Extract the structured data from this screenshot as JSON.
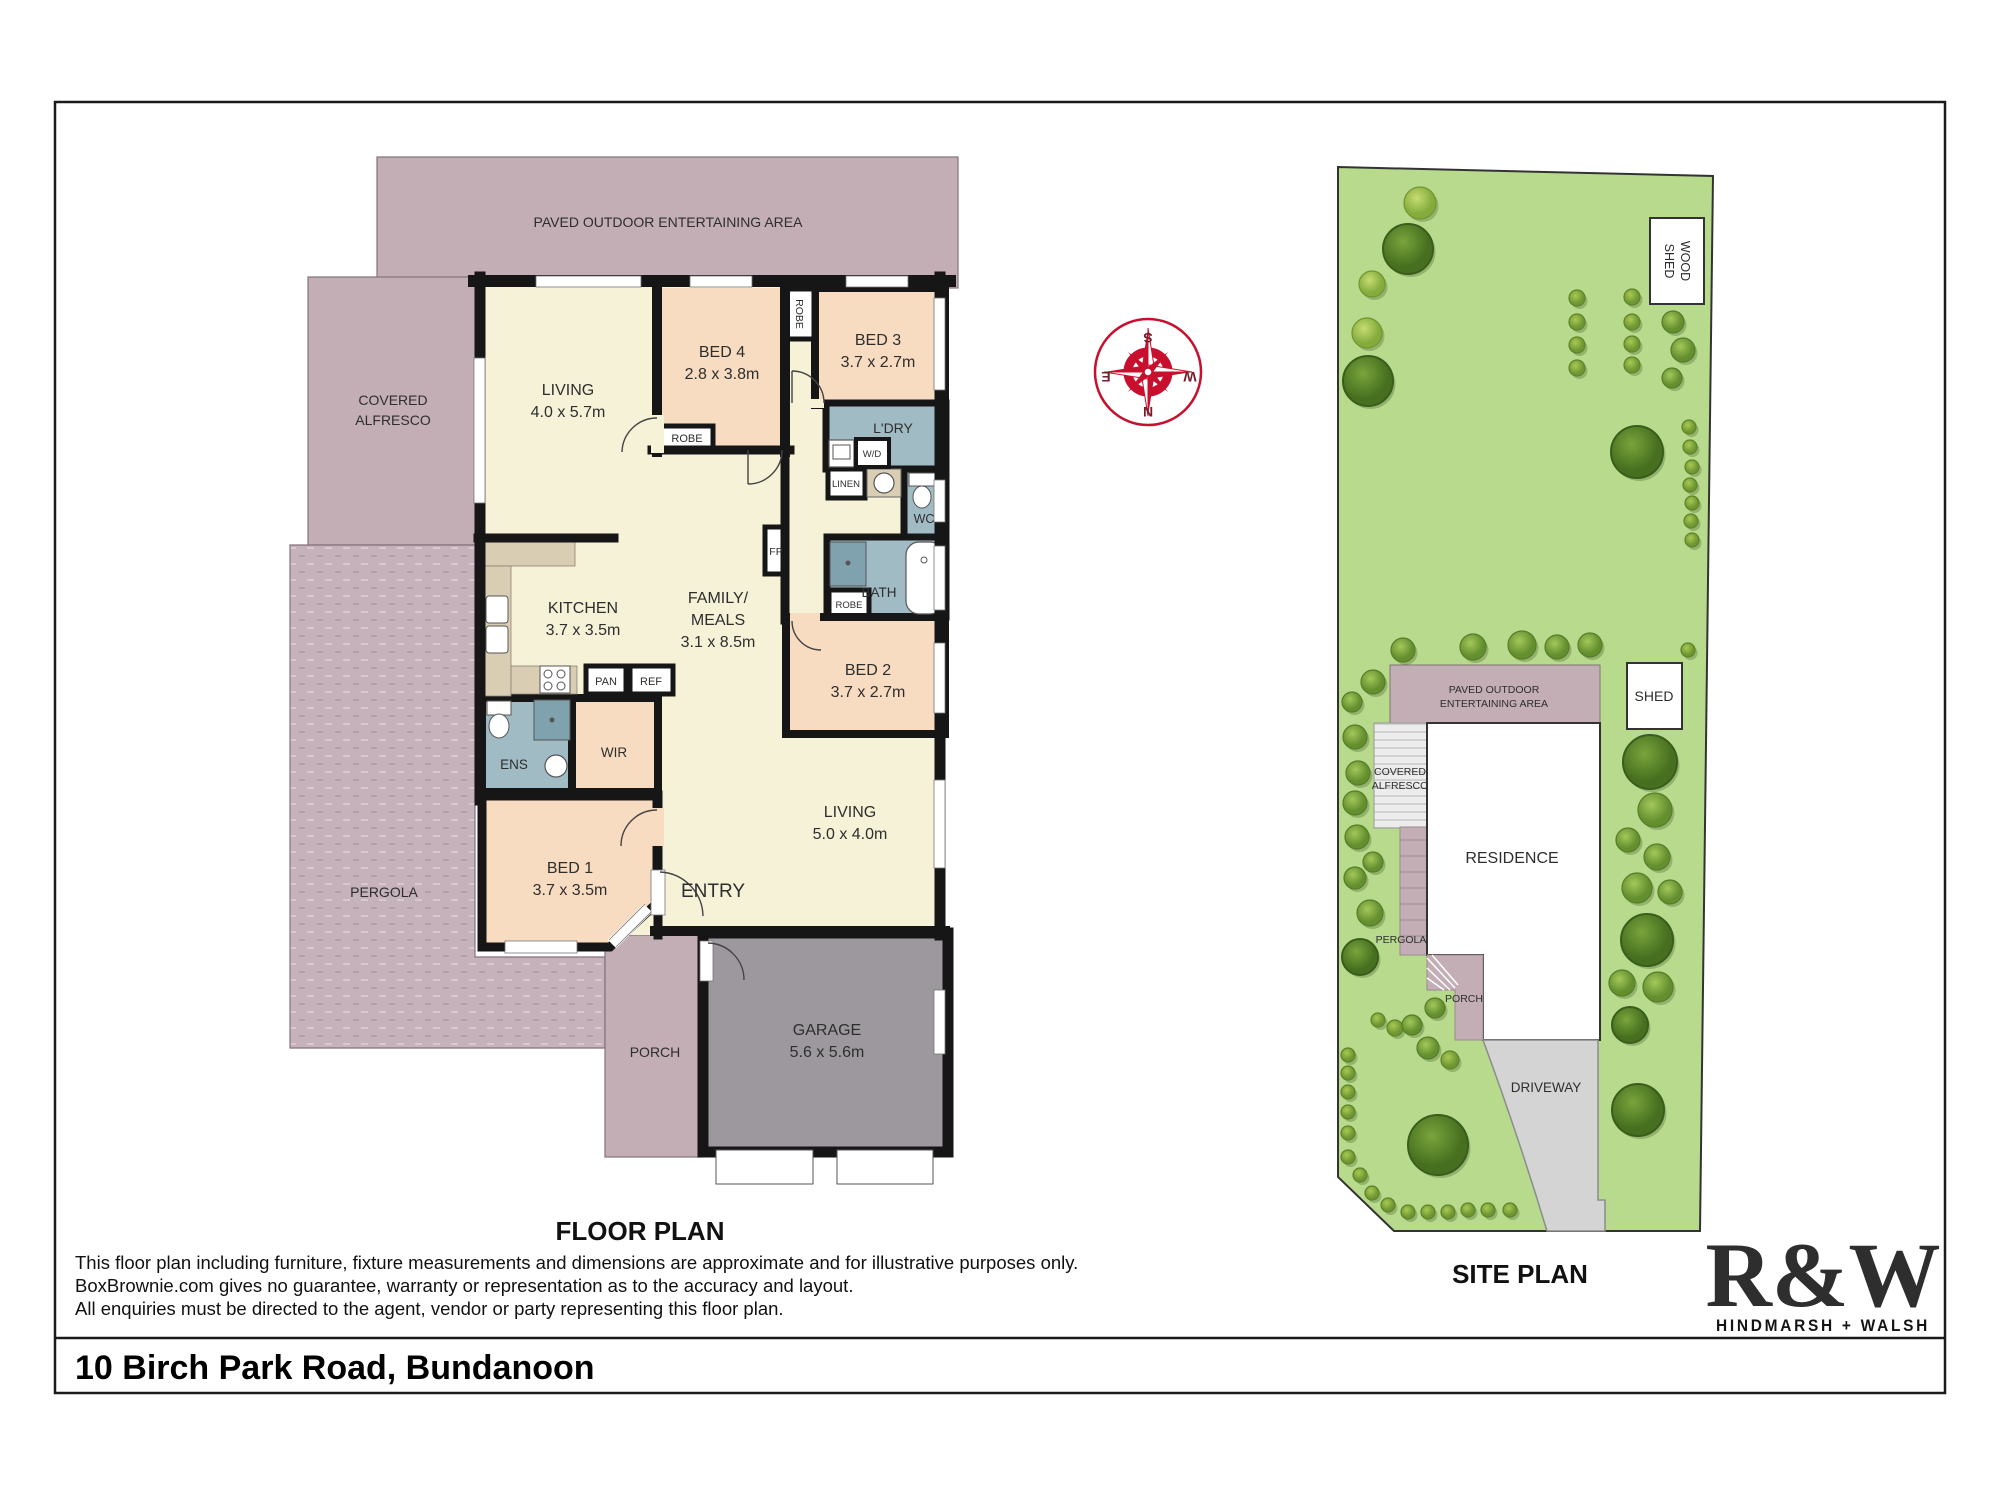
{
  "floor_plan": {
    "title": "FLOOR PLAN",
    "rooms": {
      "paved_area": {
        "label": "PAVED OUTDOOR ENTERTAINING AREA"
      },
      "covered_alfresco": {
        "line1": "COVERED",
        "line2": "ALFRESCO"
      },
      "pergola": {
        "label": "PERGOLA"
      },
      "porch": {
        "label": "PORCH"
      },
      "living1": {
        "label": "LIVING",
        "dims": "4.0 x 5.7m"
      },
      "bed4": {
        "label": "BED 4",
        "dims": "2.8 x 3.8m"
      },
      "bed3": {
        "label": "BED 3",
        "dims": "3.7 x 2.7m"
      },
      "ldry": {
        "label": "L'DRY"
      },
      "wd": {
        "label": "W/D"
      },
      "linen": {
        "label": "LINEN"
      },
      "wc": {
        "label": "WC"
      },
      "bath": {
        "label": "BATH"
      },
      "robe": {
        "label": "ROBE"
      },
      "kitchen": {
        "label": "KITCHEN",
        "dims": "3.7 x 3.5m"
      },
      "family": {
        "line1": "FAMILY/",
        "line2": "MEALS",
        "dims": "3.1 x 8.5m"
      },
      "fp": {
        "label": "FP"
      },
      "pan": {
        "label": "PAN"
      },
      "ref": {
        "label": "REF"
      },
      "bed2": {
        "label": "BED 2",
        "dims": "3.7 x 2.7m"
      },
      "living2": {
        "label": "LIVING",
        "dims": "5.0 x 4.0m"
      },
      "ens": {
        "label": "ENS"
      },
      "wir": {
        "label": "WIR"
      },
      "bed1": {
        "label": "BED 1",
        "dims": "3.7 x 3.5m"
      },
      "entry": {
        "label": "ENTRY"
      },
      "garage": {
        "label": "GARAGE",
        "dims": "5.6 x 5.6m"
      }
    }
  },
  "site_plan": {
    "title": "SITE PLAN",
    "labels": {
      "wood_shed_line1": "WOOD",
      "wood_shed_line2": "SHED",
      "shed": "SHED",
      "paved_line1": "PAVED OUTDOOR",
      "paved_line2": "ENTERTAINING AREA",
      "alfresco_line1": "COVERED",
      "alfresco_line2": "ALFRESCO",
      "residence": "RESIDENCE",
      "pergola": "PERGOLA",
      "porch": "PORCH",
      "driveway": "DRIVEWAY"
    },
    "trees": [
      [
        1420,
        203,
        16,
        "s"
      ],
      [
        1408,
        249,
        25,
        "b"
      ],
      [
        1372,
        284,
        13,
        "s"
      ],
      [
        1367,
        333,
        15,
        "s"
      ],
      [
        1368,
        381,
        25,
        "b"
      ],
      [
        1577,
        298,
        8,
        "t"
      ],
      [
        1632,
        297,
        8,
        "t"
      ],
      [
        1577,
        322,
        8,
        "t"
      ],
      [
        1632,
        322,
        8,
        "t"
      ],
      [
        1577,
        345,
        8,
        "t"
      ],
      [
        1632,
        344,
        8,
        "t"
      ],
      [
        1577,
        368,
        8,
        "t"
      ],
      [
        1632,
        365,
        8,
        "t"
      ],
      [
        1673,
        322,
        11,
        "m"
      ],
      [
        1683,
        350,
        12,
        "m"
      ],
      [
        1672,
        378,
        10,
        "m"
      ],
      [
        1637,
        452,
        26,
        "b"
      ],
      [
        1689,
        427,
        7,
        "t"
      ],
      [
        1690,
        447,
        7,
        "t"
      ],
      [
        1692,
        467,
        7,
        "t"
      ],
      [
        1690,
        485,
        7,
        "t"
      ],
      [
        1692,
        503,
        7,
        "t"
      ],
      [
        1691,
        521,
        7,
        "t"
      ],
      [
        1692,
        540,
        7,
        "t"
      ],
      [
        1403,
        650,
        12,
        "m"
      ],
      [
        1373,
        682,
        12,
        "m"
      ],
      [
        1352,
        702,
        10,
        "m"
      ],
      [
        1473,
        647,
        13,
        "m"
      ],
      [
        1522,
        645,
        14,
        "m"
      ],
      [
        1557,
        647,
        12,
        "m"
      ],
      [
        1590,
        645,
        12,
        "m"
      ],
      [
        1688,
        650,
        7,
        "t"
      ],
      [
        1355,
        737,
        12,
        "m"
      ],
      [
        1358,
        773,
        12,
        "m"
      ],
      [
        1355,
        803,
        12,
        "m"
      ],
      [
        1357,
        837,
        12,
        "m"
      ],
      [
        1373,
        862,
        10,
        "m"
      ],
      [
        1355,
        878,
        11,
        "m"
      ],
      [
        1370,
        913,
        13,
        "m"
      ],
      [
        1360,
        957,
        18,
        "b"
      ],
      [
        1650,
        762,
        27,
        "b"
      ],
      [
        1655,
        810,
        17,
        "m"
      ],
      [
        1628,
        840,
        12,
        "m"
      ],
      [
        1657,
        857,
        13,
        "m"
      ],
      [
        1637,
        888,
        15,
        "m"
      ],
      [
        1670,
        892,
        12,
        "m"
      ],
      [
        1647,
        940,
        26,
        "b"
      ],
      [
        1622,
        983,
        13,
        "m"
      ],
      [
        1658,
        987,
        15,
        "m"
      ],
      [
        1630,
        1025,
        18,
        "b"
      ],
      [
        1378,
        1020,
        7,
        "t"
      ],
      [
        1395,
        1028,
        8,
        "t"
      ],
      [
        1412,
        1025,
        10,
        "m"
      ],
      [
        1435,
        1008,
        10,
        "m"
      ],
      [
        1428,
        1048,
        11,
        "m"
      ],
      [
        1450,
        1060,
        9,
        "t"
      ],
      [
        1348,
        1055,
        7,
        "t"
      ],
      [
        1348,
        1073,
        7,
        "t"
      ],
      [
        1348,
        1092,
        7,
        "t"
      ],
      [
        1348,
        1112,
        7,
        "t"
      ],
      [
        1348,
        1133,
        7,
        "t"
      ],
      [
        1348,
        1157,
        7,
        "t"
      ],
      [
        1360,
        1175,
        7,
        "t"
      ],
      [
        1372,
        1193,
        7,
        "t"
      ],
      [
        1388,
        1205,
        7,
        "t"
      ],
      [
        1408,
        1212,
        7,
        "t"
      ],
      [
        1428,
        1212,
        7,
        "t"
      ],
      [
        1448,
        1212,
        7,
        "t"
      ],
      [
        1468,
        1210,
        7,
        "t"
      ],
      [
        1488,
        1210,
        7,
        "t"
      ],
      [
        1510,
        1210,
        7,
        "t"
      ],
      [
        1438,
        1145,
        30,
        "b"
      ],
      [
        1638,
        1110,
        26,
        "b"
      ]
    ]
  },
  "compass": {
    "n": "N",
    "s": "S",
    "e": "E",
    "w": "W"
  },
  "disclaimer": {
    "line1": "This floor plan including furniture, fixture measurements and dimensions are approximate and for illustrative purposes only.",
    "line2": "BoxBrownie.com gives no guarantee, warranty or representation as to the accuracy and layout.",
    "line3": "All enquiries must be directed to the agent, vendor or party representing this floor plan."
  },
  "address": "10 Birch Park Road, Bundanoon",
  "brand": {
    "logo": "R&W",
    "name": "HINDMARSH + WALSH"
  },
  "colors": {
    "brand_red": "#e4183c",
    "wall": "#161616",
    "mauve_paving": "#c3aeb6",
    "room_yellow": "#f6f2d8",
    "room_peach": "#f8dcc1",
    "wet_blue": "#a0bbc4",
    "bench_tan": "#d9cdb4",
    "garage_gray": "#9c989d",
    "lawn_green": "#b7da8c",
    "driveway_gray": "#d4d4d4"
  }
}
